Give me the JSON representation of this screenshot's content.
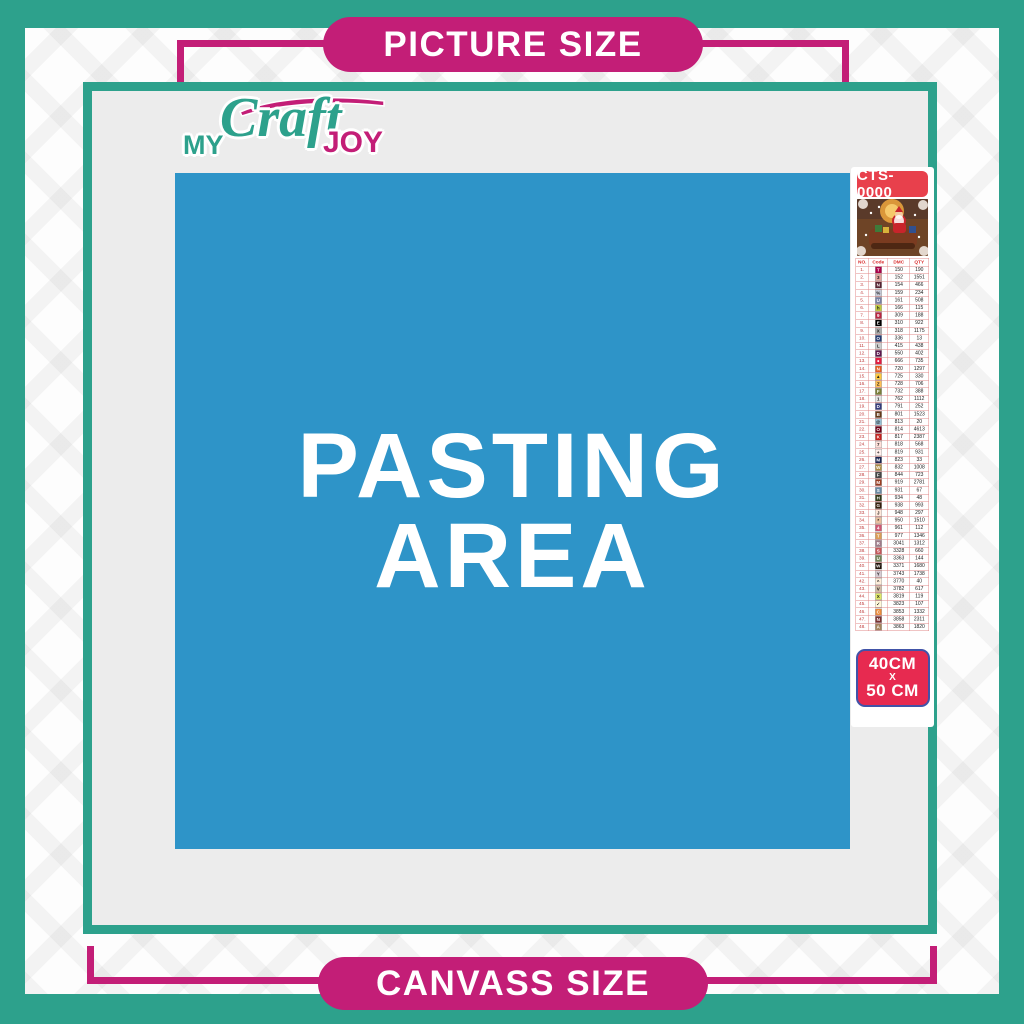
{
  "banners": {
    "top": "PICTURE SIZE",
    "bottom": "CANVASS SIZE"
  },
  "logo": {
    "word1": "MY",
    "word2": "Craft",
    "word3": "JOY"
  },
  "pasting_area": {
    "line1": "PASTING",
    "line2": "AREA"
  },
  "product": {
    "code": "CTS-0000",
    "size_line1": "40CM",
    "size_sep": "X",
    "size_line2": "50 CM",
    "thumbnail": "christmas-santa-sleigh-scene"
  },
  "colors": {
    "teal": "#2DA18C",
    "magenta": "#C31E77",
    "blue": "#2E94C8",
    "badge_red": "#E8404C",
    "size_badge_red": "#E72A50",
    "size_badge_border": "#4153A8",
    "content_gray": "#ECECEC"
  },
  "color_table": {
    "headers": [
      "NO.",
      "Code",
      "DMC",
      "QTY"
    ],
    "rows": [
      {
        "no": "1.",
        "symbol": "T",
        "swatch": "#AB0249",
        "symcolor": "#fff",
        "dmc": "150",
        "qty": "190"
      },
      {
        "no": "2.",
        "symbol": "3",
        "swatch": "#E2A099",
        "symcolor": "#222",
        "dmc": "152",
        "qty": "1551"
      },
      {
        "no": "3.",
        "symbol": "N",
        "swatch": "#572433",
        "symcolor": "#fff",
        "dmc": "154",
        "qty": "466"
      },
      {
        "no": "4.",
        "symbol": "%",
        "swatch": "#C7CAD7",
        "symcolor": "#222",
        "dmc": "159",
        "qty": "234"
      },
      {
        "no": "5.",
        "symbol": "U",
        "swatch": "#7880A4",
        "symcolor": "#fff",
        "dmc": "161",
        "qty": "508"
      },
      {
        "no": "6.",
        "symbol": "h",
        "swatch": "#C0C840",
        "symcolor": "#222",
        "dmc": "166",
        "qty": "115"
      },
      {
        "no": "7.",
        "symbol": "9",
        "swatch": "#BA2742",
        "symcolor": "#fff",
        "dmc": "309",
        "qty": "188"
      },
      {
        "no": "8.",
        "symbol": "E",
        "swatch": "#000000",
        "symcolor": "#fff",
        "dmc": "310",
        "qty": "922"
      },
      {
        "no": "9.",
        "symbol": "X",
        "swatch": "#ABABAB",
        "symcolor": "#222",
        "dmc": "318",
        "qty": "1175"
      },
      {
        "no": "10.",
        "symbol": "O",
        "swatch": "#253B73",
        "symcolor": "#fff",
        "dmc": "336",
        "qty": "13"
      },
      {
        "no": "11.",
        "symbol": "L",
        "swatch": "#CCCCCC",
        "symcolor": "#222",
        "dmc": "415",
        "qty": "438"
      },
      {
        "no": "12.",
        "symbol": "D",
        "swatch": "#5C184E",
        "symcolor": "#fff",
        "dmc": "550",
        "qty": "402"
      },
      {
        "no": "13.",
        "symbol": "●",
        "swatch": "#E31D42",
        "symcolor": "#fff",
        "dmc": "666",
        "qty": "735"
      },
      {
        "no": "14.",
        "symbol": "N",
        "swatch": "#E55C1F",
        "symcolor": "#fff",
        "dmc": "720",
        "qty": "1297"
      },
      {
        "no": "15.",
        "symbol": "▲",
        "swatch": "#FFC840",
        "symcolor": "#222",
        "dmc": "725",
        "qty": "330"
      },
      {
        "no": "16.",
        "symbol": "Z",
        "swatch": "#FFBF57",
        "symcolor": "#222",
        "dmc": "728",
        "qty": "706"
      },
      {
        "no": "17.",
        "symbol": "F",
        "swatch": "#7B7E39",
        "symcolor": "#fff",
        "dmc": "732",
        "qty": "388"
      },
      {
        "no": "18.",
        "symbol": "1",
        "swatch": "#E4E4E4",
        "symcolor": "#222",
        "dmc": "762",
        "qty": "1112"
      },
      {
        "no": "19.",
        "symbol": "D",
        "swatch": "#343B7C",
        "symcolor": "#fff",
        "dmc": "791",
        "qty": "252"
      },
      {
        "no": "20.",
        "symbol": "B",
        "swatch": "#653919",
        "symcolor": "#fff",
        "dmc": "801",
        "qty": "1523"
      },
      {
        "no": "21.",
        "symbol": "@",
        "swatch": "#99C3D8",
        "symcolor": "#222",
        "dmc": "813",
        "qty": "20"
      },
      {
        "no": "22.",
        "symbol": "O",
        "swatch": "#700219",
        "symcolor": "#fff",
        "dmc": "814",
        "qty": "4613"
      },
      {
        "no": "23.",
        "symbol": "K",
        "swatch": "#C4221F",
        "symcolor": "#fff",
        "dmc": "817",
        "qty": "2387"
      },
      {
        "no": "24.",
        "symbol": "7",
        "swatch": "#FFDFD9",
        "symcolor": "#222",
        "dmc": "818",
        "qty": "568"
      },
      {
        "no": "25.",
        "symbol": "+",
        "swatch": "#FFEEEB",
        "symcolor": "#222",
        "dmc": "819",
        "qty": "931"
      },
      {
        "no": "26.",
        "symbol": "M",
        "swatch": "#1A2551",
        "symcolor": "#fff",
        "dmc": "823",
        "qty": "33"
      },
      {
        "no": "27.",
        "symbol": "W",
        "swatch": "#AD8C44",
        "symcolor": "#fff",
        "dmc": "832",
        "qty": "1008"
      },
      {
        "no": "28.",
        "symbol": "F",
        "swatch": "#484848",
        "symcolor": "#fff",
        "dmc": "844",
        "qty": "723"
      },
      {
        "no": "29.",
        "symbol": "M",
        "swatch": "#9C3E22",
        "symcolor": "#fff",
        "dmc": "919",
        "qty": "2781"
      },
      {
        "no": "30.",
        "symbol": "S",
        "swatch": "#6A8AA5",
        "symcolor": "#fff",
        "dmc": "931",
        "qty": "67"
      },
      {
        "no": "31.",
        "symbol": "H",
        "swatch": "#313919",
        "symcolor": "#fff",
        "dmc": "934",
        "qty": "48"
      },
      {
        "no": "32.",
        "symbol": "G",
        "swatch": "#361F0E",
        "symcolor": "#fff",
        "dmc": "938",
        "qty": "993"
      },
      {
        "no": "33.",
        "symbol": "J",
        "swatch": "#FEE7DA",
        "symcolor": "#222",
        "dmc": "948",
        "qty": "297"
      },
      {
        "no": "34.",
        "symbol": "*",
        "swatch": "#E9BF9F",
        "symcolor": "#222",
        "dmc": "950",
        "qty": "1510"
      },
      {
        "no": "35.",
        "symbol": "4",
        "swatch": "#CF5773",
        "symcolor": "#fff",
        "dmc": "961",
        "qty": "112"
      },
      {
        "no": "36.",
        "symbol": "T",
        "swatch": "#DC9C56",
        "symcolor": "#fff",
        "dmc": "977",
        "qty": "1346"
      },
      {
        "no": "37.",
        "symbol": "R",
        "swatch": "#9F7C8A",
        "symcolor": "#fff",
        "dmc": "3041",
        "qty": "1312"
      },
      {
        "no": "38.",
        "symbol": "S",
        "swatch": "#C5575A",
        "symcolor": "#fff",
        "dmc": "3328",
        "qty": "660"
      },
      {
        "no": "39.",
        "symbol": "U",
        "swatch": "#728256",
        "symcolor": "#fff",
        "dmc": "3363",
        "qty": "144"
      },
      {
        "no": "40.",
        "symbol": "W",
        "swatch": "#1E1108",
        "symcolor": "#fff",
        "dmc": "3371",
        "qty": "1680"
      },
      {
        "no": "41.",
        "symbol": "Y",
        "swatch": "#D7CBD3",
        "symcolor": "#222",
        "dmc": "3743",
        "qty": "1738"
      },
      {
        "no": "42.",
        "symbol": "^",
        "swatch": "#FEEDDA",
        "symcolor": "#222",
        "dmc": "3770",
        "qty": "40"
      },
      {
        "no": "43.",
        "symbol": "V",
        "swatch": "#D2BCA6",
        "symcolor": "#222",
        "dmc": "3782",
        "qty": "617"
      },
      {
        "no": "44.",
        "symbol": "X",
        "swatch": "#E0E868",
        "symcolor": "#222",
        "dmc": "3819",
        "qty": "119"
      },
      {
        "no": "45.",
        "symbol": "✓",
        "swatch": "#FFF8D9",
        "symcolor": "#222",
        "dmc": "3823",
        "qty": "107"
      },
      {
        "no": "46.",
        "symbol": "C",
        "swatch": "#EB8B3C",
        "symcolor": "#fff",
        "dmc": "3853",
        "qty": "1332"
      },
      {
        "no": "47.",
        "symbol": "N",
        "swatch": "#7A3232",
        "symcolor": "#fff",
        "dmc": "3858",
        "qty": "2311"
      },
      {
        "no": "48.",
        "symbol": "A",
        "swatch": "#A4835C",
        "symcolor": "#fff",
        "dmc": "3863",
        "qty": "1820"
      }
    ]
  }
}
